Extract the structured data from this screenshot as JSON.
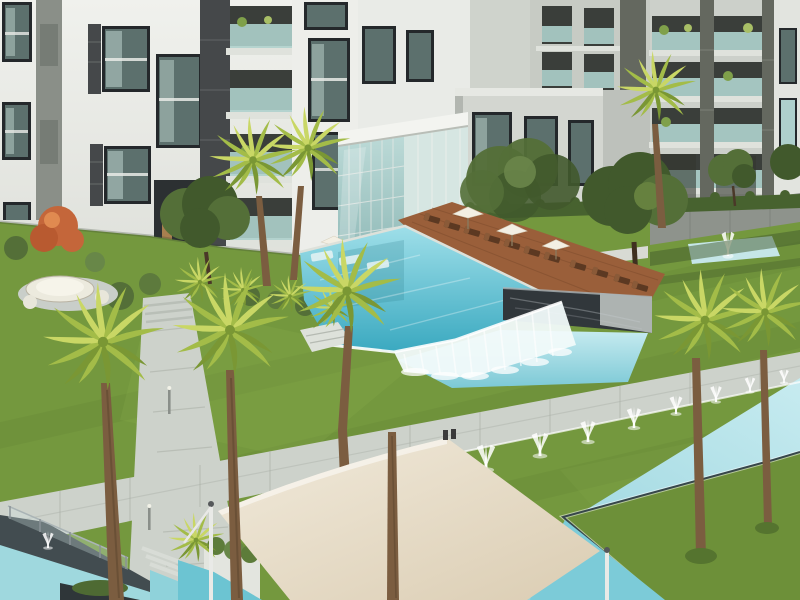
{
  "scene": {
    "description": "Architectural rendering of a modern residential compound courtyard: white and gray apartment buildings with dark-framed windows and teal glass balconies, a double-height glass entrance pavilion, a turquoise swimming pool with sun deck, loungers and white umbrellas, a waterfall edge spilling into a lower pool beside a dark marble wall, a sunken fountain court, lawns crossed by pale stone walkways, a long fountain channel with water jets, a cream shade sail over a small pool, and many palm trees in the foreground.",
    "elements": [
      "apartment-building-left",
      "glass-entrance-pavilion",
      "mid-rise-wing",
      "apartment-tower",
      "apartment-building-right",
      "lawn",
      "pool-deck",
      "sun-loungers",
      "pool-umbrellas",
      "main-pool",
      "waterfall-edge",
      "lower-pool",
      "marble-water-wall",
      "fountain-court",
      "walkway-main",
      "walkway-cross",
      "reflecting-channel-left",
      "fountain-channel",
      "fountain-jets",
      "grass-island",
      "shade-sail",
      "round-daybed",
      "palm-trees",
      "olive-trees",
      "orange-shrub",
      "planter-boxes",
      "glass-balustrade",
      "bollard-lights"
    ]
  },
  "palette": {
    "facade_white": "#edeeea",
    "facade_light": "#e2e4df",
    "facade_gray": "#c7cbc4",
    "facade_mid": "#b3b7b0",
    "wall_dark_stripe": "#8a8f88",
    "window_frame": "#24282b",
    "window_glass": "#5c706d",
    "glass_reflect": "#bdd3cd",
    "balcony_dark": "#3a3e3a",
    "balcony_glass": "#aed0cc",
    "slab_white": "#dfe2dc",
    "stone_dark": "#45484a",
    "stone_mid": "#64685f",
    "pavilion_frame": "#f3f4f0",
    "pavilion_glass_a": "#bcdad7",
    "pavilion_glass_b": "#8fb9b7",
    "grass": "#74983e",
    "grass_light": "#86aa4a",
    "grass_dark": "#5a7830",
    "hedge": "#47622f",
    "tree_olive": "#546f38",
    "tree_dark": "#41592c",
    "shrub_orange": "#c4663a",
    "palm_light": "#c9d765",
    "palm_mid": "#a3bc48",
    "palm_dark": "#7a9734",
    "trunk": "#7b5d40",
    "trunk_dark": "#5f4830",
    "pool_light": "#9fdfe9",
    "pool_deep": "#3aa9c0",
    "channel_light": "#c7ebf0",
    "channel_deep": "#8fd0da",
    "waterfall": "#f1fafa",
    "deck": "#9a5f3a",
    "deck_dark": "#6f4226",
    "lounger": "#5c3922",
    "umbrella": "#f3efe3",
    "path": "#cdd2cb",
    "path_edge": "#a9afa6",
    "coping": "#dde1da",
    "marble_dark": "#31373b",
    "marble_light": "#c3c9c7",
    "marble_vein": "#c9cfd2",
    "sail": "#ece3d0",
    "sail_deep": "#dbcdb3",
    "water_dark": "#424c50",
    "white": "#ffffff",
    "post": "#e9eae7"
  }
}
